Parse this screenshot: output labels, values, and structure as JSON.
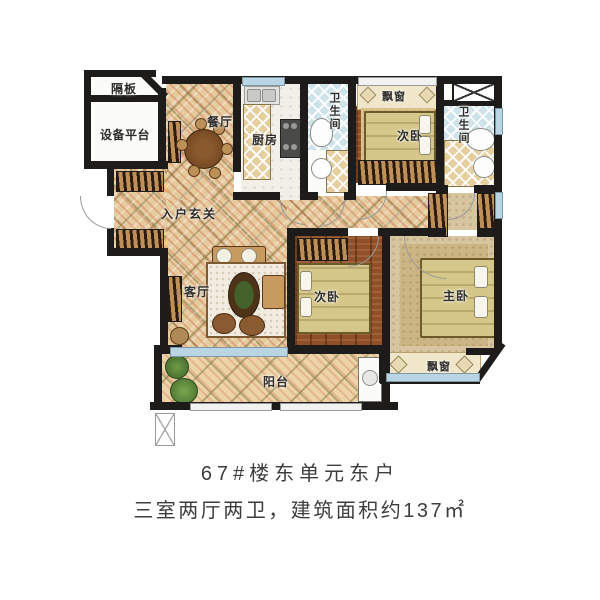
{
  "caption": {
    "line1": "67#楼东单元东户",
    "line2": "三室两厅两卫，建筑面积约137㎡"
  },
  "rooms": {
    "partition": "隔板",
    "equipment_platform": "设备平台",
    "dining": "餐厅",
    "kitchen": "厨房",
    "bath1": "卫生间",
    "bay_window_top": "飘窗",
    "bedroom1": "次卧",
    "bath2": "卫生间",
    "entry": "入户玄关",
    "living": "客厅",
    "bedroom2": "次卧",
    "master": "主卧",
    "balcony": "阳台",
    "bay_window_bottom": "飘窗"
  },
  "colors": {
    "wall": "#1d1c1a",
    "tile": "#e6cb9e",
    "wood": "#8e4f29",
    "window": "#b9d4e3",
    "text": "#3e3d3b"
  }
}
